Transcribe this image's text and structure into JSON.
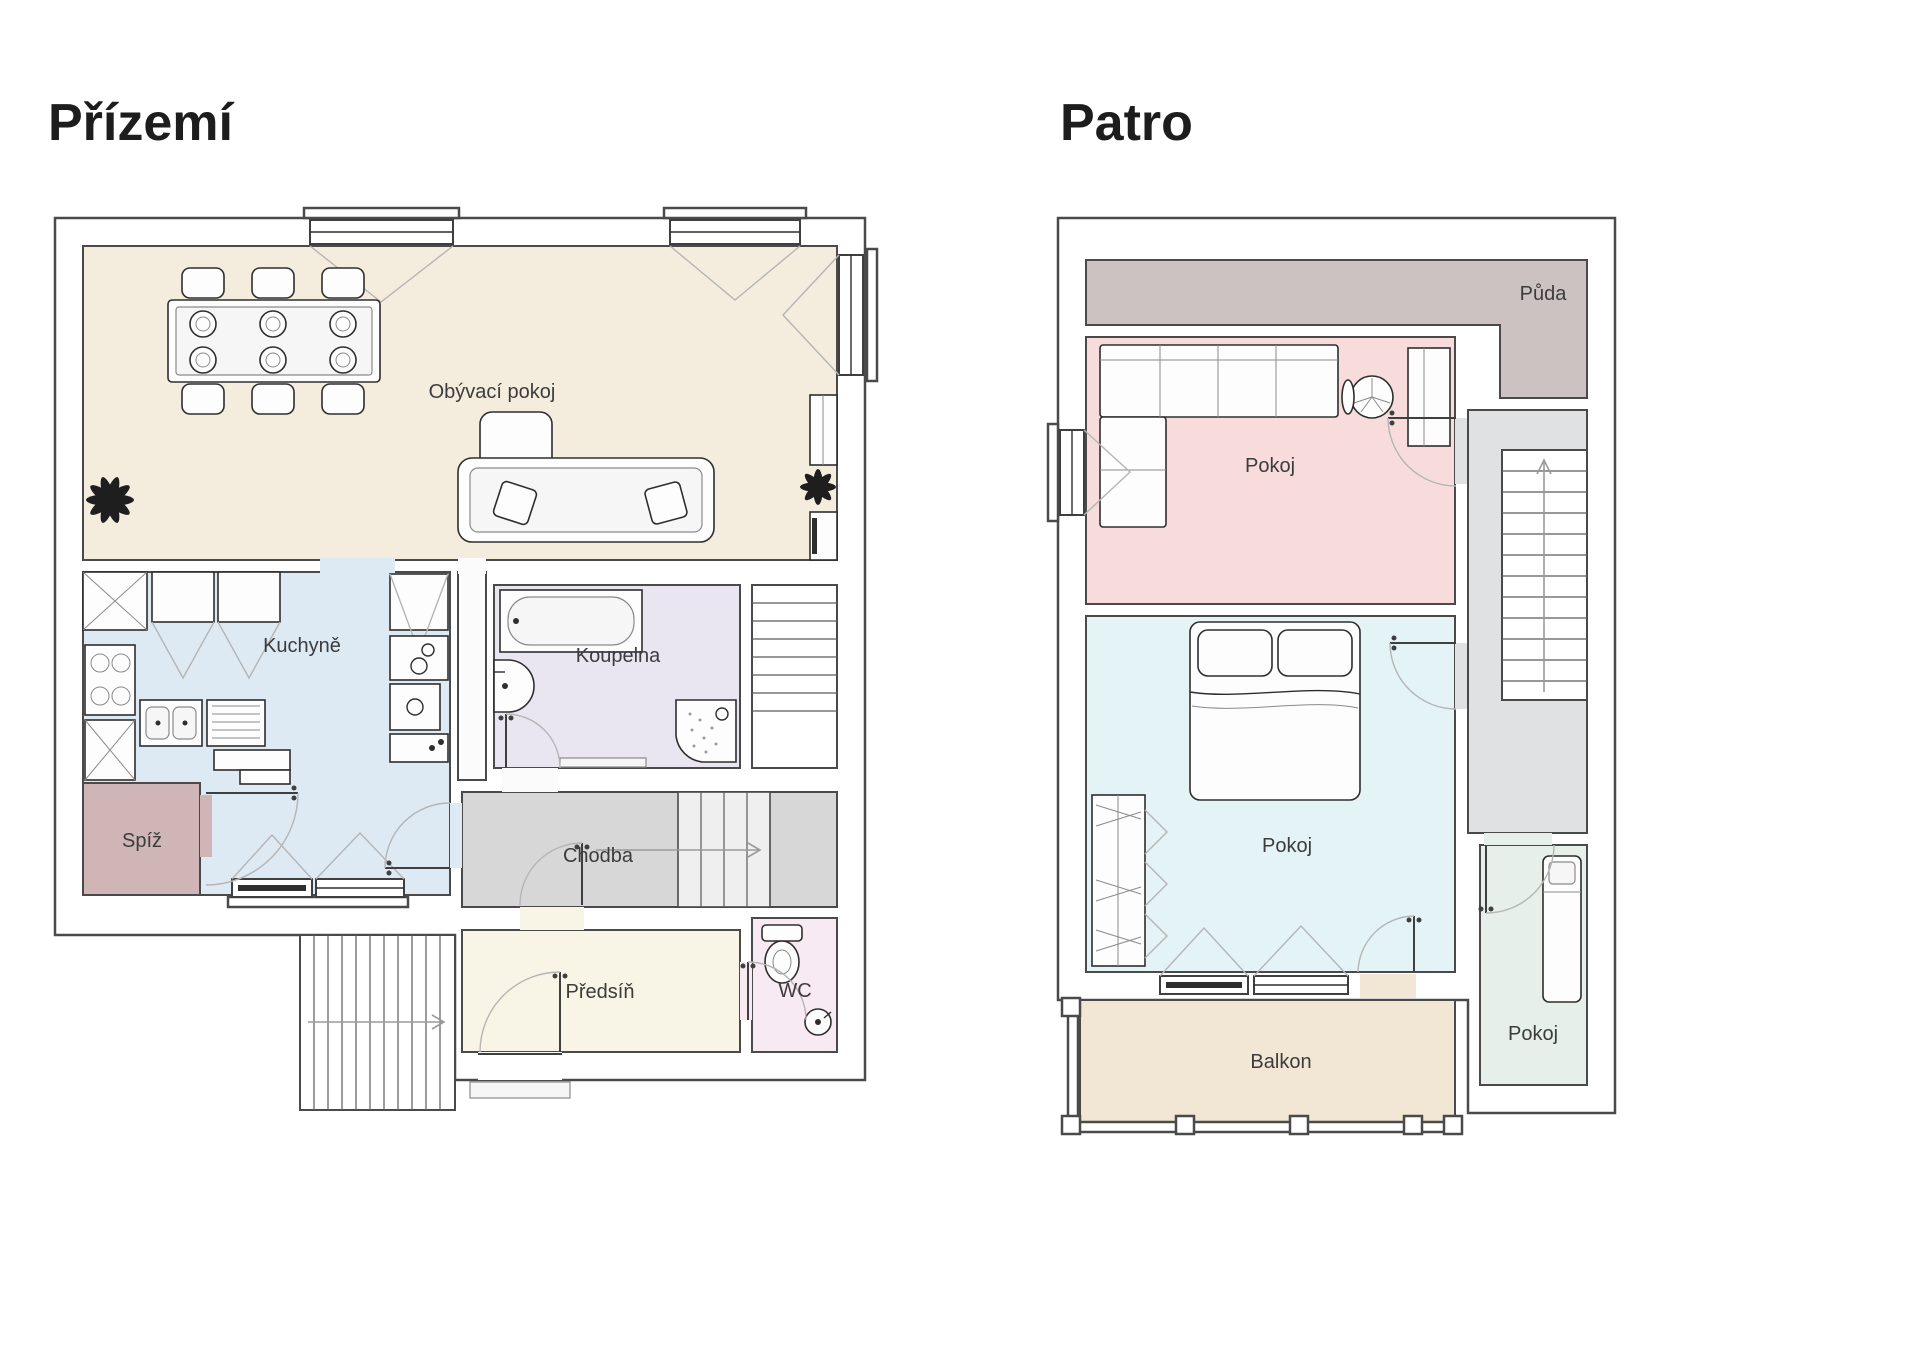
{
  "page": {
    "background": "#ffffff"
  },
  "floors": [
    {
      "title": "Přízemí",
      "rooms": [
        {
          "id": "obyvaci",
          "name": "Obývací pokoj"
        },
        {
          "id": "kuchyne",
          "name": "Kuchyně"
        },
        {
          "id": "koupelna",
          "name": "Koupelna"
        },
        {
          "id": "spiz",
          "name": "Spíž"
        },
        {
          "id": "chodba",
          "name": "Chodba"
        },
        {
          "id": "predsin",
          "name": "Předsíň"
        },
        {
          "id": "wc",
          "name": "WC"
        }
      ]
    },
    {
      "title": "Patro",
      "rooms": [
        {
          "id": "puda",
          "name": "Půda"
        },
        {
          "id": "pokoj_horni",
          "name": "Pokoj"
        },
        {
          "id": "pokoj_stredni",
          "name": "Pokoj"
        },
        {
          "id": "pokoj_dolni",
          "name": "Pokoj"
        },
        {
          "id": "balkon",
          "name": "Balkon"
        }
      ]
    }
  ],
  "colors": {
    "wall_stroke": "#4a4a4a",
    "living": "#f4eddd",
    "kitchen": "#dde9f3",
    "bathroom": "#e9e6f1",
    "pantry": "#cfb5b5",
    "hallway": "#d7d7d7",
    "entry": "#f9f5e6",
    "wc": "#f7eaf2",
    "attic": "#cdc2c2",
    "room_pink": "#f7dcdb",
    "room_cyan": "#e3f3f6",
    "room_green": "#e6efe9",
    "balcony": "#f1e7d4",
    "landing": "#e0e1e3"
  }
}
